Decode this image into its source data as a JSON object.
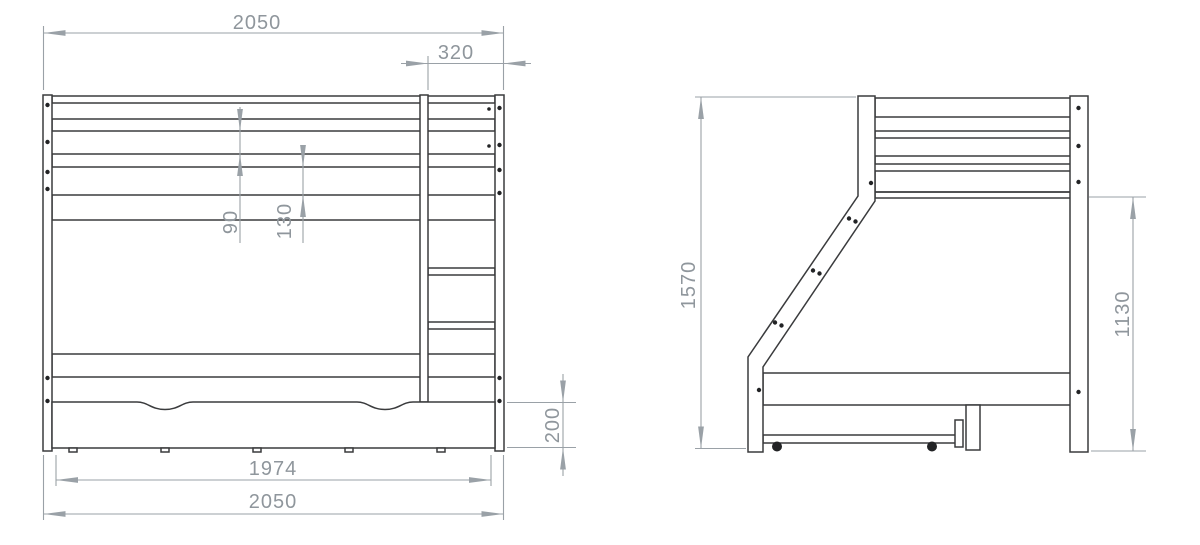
{
  "drawing": {
    "title": "Bunk bed technical drawing, two orthographic views with millimetre dimensions",
    "units": "mm",
    "colors": {
      "background": "#ffffff",
      "structure_line": "#3a3b3d",
      "dimension_line": "#9aa1a7",
      "dimension_text": "#8f969c"
    },
    "views": {
      "front": {
        "label": "front-elevation",
        "dims": {
          "overall_width_top": "2050",
          "ladder_width": "320",
          "guard_rail_gap": "90",
          "rail_to_frame_gap": "130",
          "drawer_height": "200",
          "drawer_width": "1974",
          "overall_width_bottom": "2050"
        }
      },
      "side": {
        "label": "side-elevation",
        "dims": {
          "overall_height": "1570",
          "upper_bed_height": "1130"
        }
      }
    }
  }
}
